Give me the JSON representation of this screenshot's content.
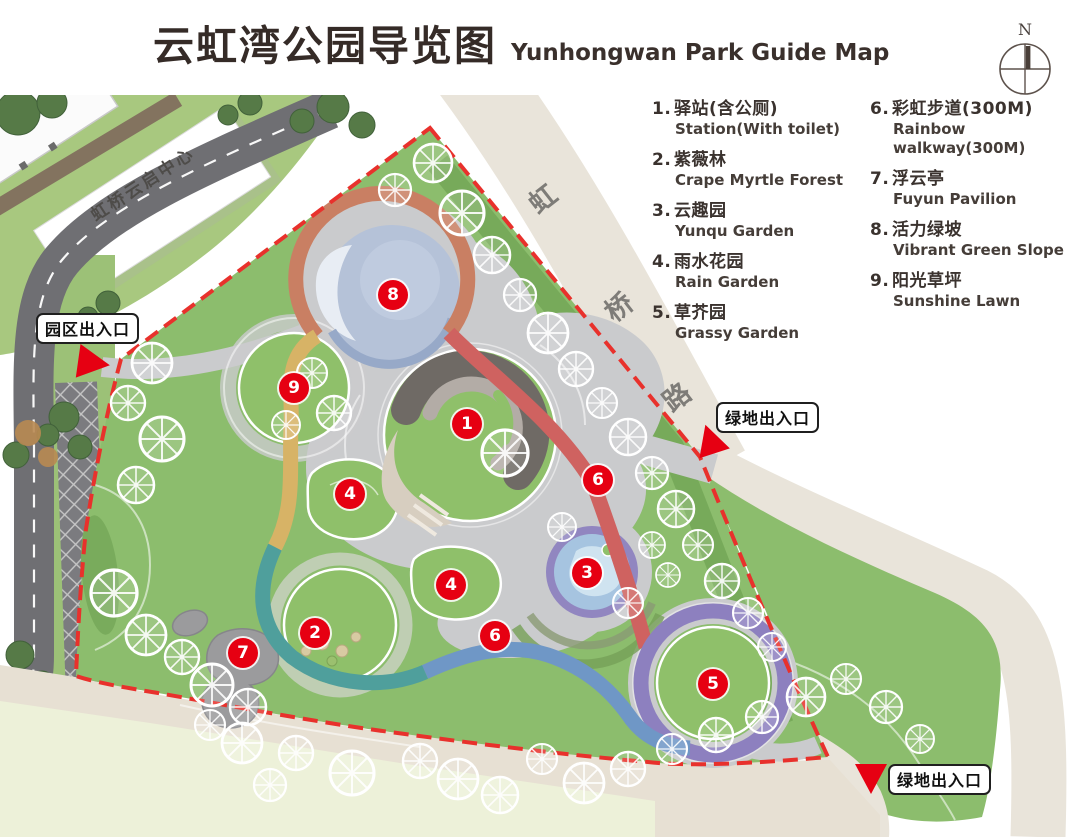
{
  "header": {
    "title_cn": "云虹湾公园导览图",
    "title_en": "Yunhongwan Park Guide Map"
  },
  "compass": {
    "label": "N"
  },
  "legend": {
    "columns": [
      {
        "items": [
          {
            "num": "1",
            "cn": "驿站(含公厕)",
            "en": "Station(With toilet)"
          },
          {
            "num": "2",
            "cn": "紫薇林",
            "en": "Crape Myrtle Forest"
          },
          {
            "num": "3",
            "cn": "云趣园",
            "en": "Yunqu Garden"
          },
          {
            "num": "4",
            "cn": "雨水花园",
            "en": "Rain Garden"
          },
          {
            "num": "5",
            "cn": "草芥园",
            "en": "Grassy Garden"
          }
        ]
      },
      {
        "items": [
          {
            "num": "6",
            "cn": "彩虹步道(300M)",
            "en": "Rainbow walkway(300M)"
          },
          {
            "num": "7",
            "cn": "浮云亭",
            "en": "Fuyun Pavilion"
          },
          {
            "num": "8",
            "cn": "活力绿坡",
            "en": "Vibrant Green Slope"
          },
          {
            "num": "9",
            "cn": "阳光草坪",
            "en": "Sunshine Lawn"
          }
        ]
      }
    ]
  },
  "map": {
    "building_label": "虹桥云启中心",
    "road": {
      "name": "虹桥路",
      "chars": [
        {
          "ch": "虹",
          "x": 528,
          "y": 178
        },
        {
          "ch": "桥",
          "x": 604,
          "y": 286
        },
        {
          "ch": "路",
          "x": 662,
          "y": 376
        }
      ]
    },
    "markers": [
      {
        "num": "1",
        "x": 467,
        "y": 424
      },
      {
        "num": "2",
        "x": 315,
        "y": 633
      },
      {
        "num": "3",
        "x": 587,
        "y": 573
      },
      {
        "num": "4",
        "x": 350,
        "y": 494
      },
      {
        "num": "4",
        "x": 451,
        "y": 585
      },
      {
        "num": "5",
        "x": 713,
        "y": 684
      },
      {
        "num": "6",
        "x": 598,
        "y": 480
      },
      {
        "num": "6",
        "x": 495,
        "y": 636
      },
      {
        "num": "7",
        "x": 243,
        "y": 653
      },
      {
        "num": "8",
        "x": 393,
        "y": 295
      },
      {
        "num": "9",
        "x": 294,
        "y": 388
      }
    ],
    "entrances": [
      {
        "label": "园区出入口",
        "box_x": 36,
        "box_y": 313,
        "tri_x": 78,
        "tri_y": 346,
        "dir": "right",
        "rot": 8
      },
      {
        "label": "绿地出入口",
        "box_x": 716,
        "box_y": 402,
        "tri_x": 694,
        "tri_y": 424,
        "dir": "up",
        "rot": -18
      },
      {
        "label": "绿地出入口",
        "box_x": 888,
        "box_y": 764,
        "tri_x": 855,
        "tri_y": 764,
        "dir": "down",
        "rot": 0
      }
    ],
    "colors": {
      "marker_red": "#e60012",
      "boundary_red": "#e8312c",
      "walk_orange": "#c97f63",
      "walk_red": "#cf6260",
      "walk_purple": "#8d80bf",
      "walk_blue": "#6f97c6",
      "walk_teal": "#4f9f9c",
      "walk_yellow": "#d7b366",
      "park_green": "#8cbd6d",
      "road_beige": "#e9e4da",
      "plaza_gray": "#cacbcd"
    }
  }
}
